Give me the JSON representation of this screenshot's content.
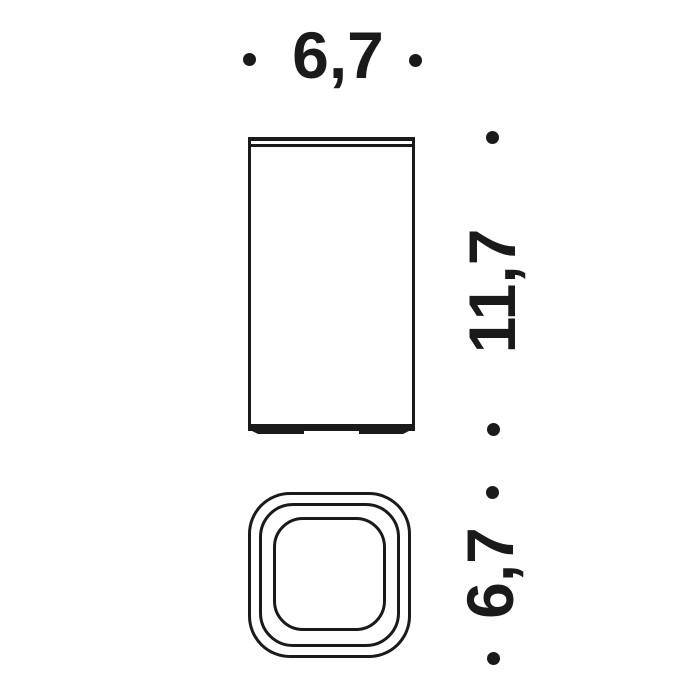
{
  "colors": {
    "line": "#1a1a1a",
    "background": "#ffffff"
  },
  "dimensions": {
    "width": {
      "label": "6,7"
    },
    "height": {
      "label": "11,7"
    },
    "depth": {
      "label": "6,7"
    }
  }
}
